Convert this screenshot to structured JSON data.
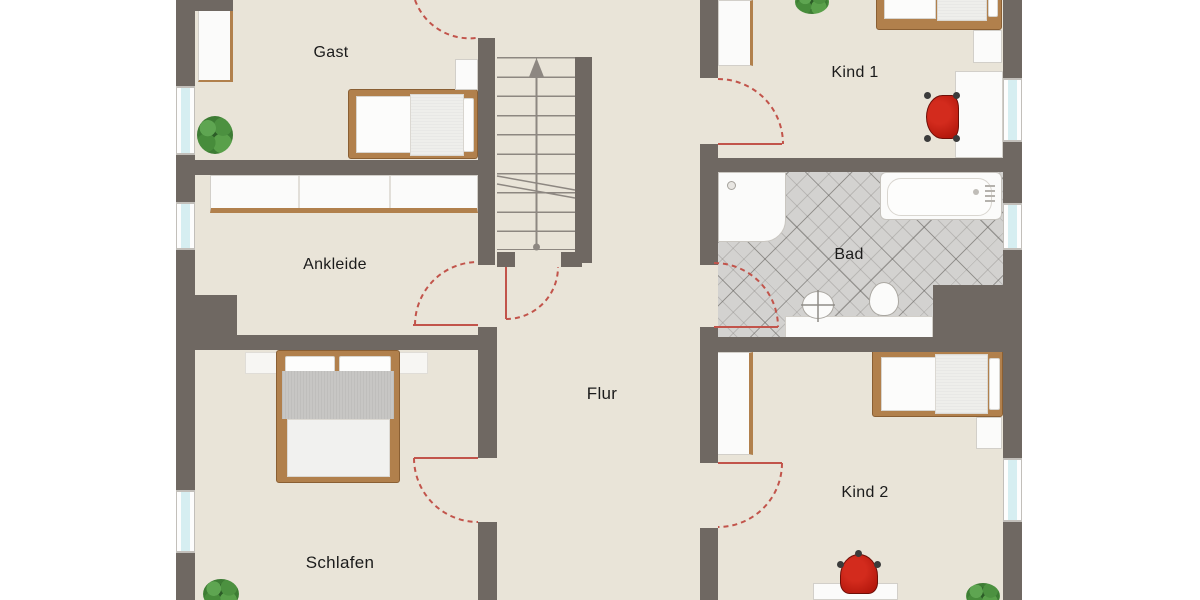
{
  "type": "floor-plan",
  "labels": {
    "gast": "Gast",
    "ankleide": "Ankleide",
    "schlafen": "Schlafen",
    "flur": "Flur",
    "bad": "Bad",
    "kind1": "Kind 1",
    "kind2": "Kind 2"
  },
  "colors": {
    "wall": "#6F6862",
    "floor": "#E9E4D8",
    "tile_floor": "#D3D2D0",
    "door_swing": "#C2544B",
    "furniture_wood": "#B1804C",
    "furniture_white": "#FBFBFA",
    "chair_red": "#BE1E15",
    "window_glass": "#D6EEF1",
    "plant_green": "#4C9140",
    "stair_line": "#8D8781"
  },
  "fixtures": [
    "staircase-up-arrow",
    "single-bed",
    "double-bed",
    "wardrobe",
    "sideboard",
    "shower",
    "bathtub",
    "washbasin",
    "toilet",
    "desk",
    "desk-chair",
    "potted-plant",
    "window",
    "door-swing"
  ]
}
